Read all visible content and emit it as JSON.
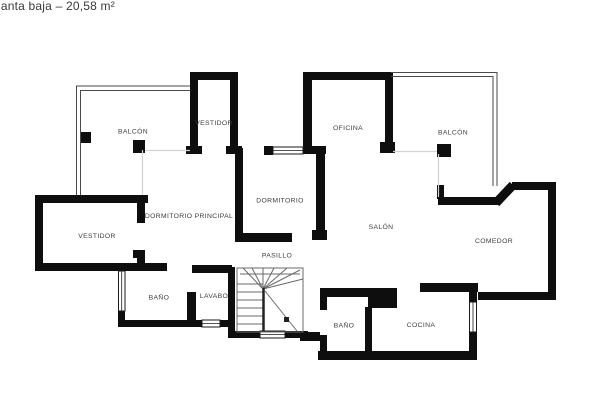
{
  "title": "lanta baja – 20,58 m²",
  "rooms": [
    {
      "id": "balcon-left",
      "label": "BALCÓN"
    },
    {
      "id": "vestidor-top",
      "label": "VESTIDOR"
    },
    {
      "id": "oficina",
      "label": "OFICINA"
    },
    {
      "id": "balcon-right",
      "label": "BALCÓN"
    },
    {
      "id": "dormitorio-principal",
      "label": "DORMITORIO PRINCIPAL"
    },
    {
      "id": "dormitorio",
      "label": "DORMITORIO"
    },
    {
      "id": "vestidor-left",
      "label": "VESTIDOR"
    },
    {
      "id": "salon",
      "label": "SALÓN"
    },
    {
      "id": "comedor",
      "label": "COMEDOR"
    },
    {
      "id": "pasillo",
      "label": "PASILLO"
    },
    {
      "id": "bano-left",
      "label": "BAÑO"
    },
    {
      "id": "lavabo",
      "label": "LAVABO"
    },
    {
      "id": "bano-right",
      "label": "BAÑO"
    },
    {
      "id": "cocina",
      "label": "COCINA"
    }
  ],
  "colors": {
    "wall": "#0e0e0e",
    "label": "#3d3d3d",
    "railing": "#4a4a4a",
    "faint_boundary": "#d2d2d2",
    "stairs_line": "#6a6a6a",
    "background": "#ffffff"
  }
}
